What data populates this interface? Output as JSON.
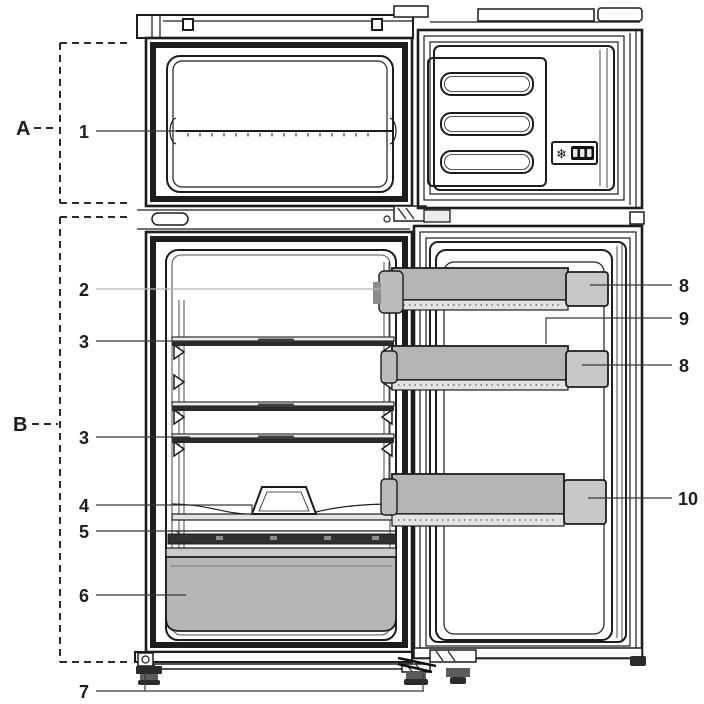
{
  "labels": {
    "a": "A",
    "b": "B",
    "n1": "1",
    "n2": "2",
    "n3a": "3",
    "n3b": "3",
    "n4": "4",
    "n5": "5",
    "n6": "6",
    "n7": "7",
    "n8a": "8",
    "n9": "9",
    "n8b": "8",
    "n10": "10"
  },
  "icons": {
    "snowflake": "❄"
  },
  "colors": {
    "line": "#1d1d1b",
    "bin_gray": "#b3b5b7",
    "cap_gray": "#c6c8ca",
    "drawer_gray": "#b4b6b8",
    "trim_dark": "#303032",
    "leader": "#3a3a3a",
    "leader_light": "#b5b6b7",
    "display_bg": "#111111",
    "background": "#ffffff"
  }
}
